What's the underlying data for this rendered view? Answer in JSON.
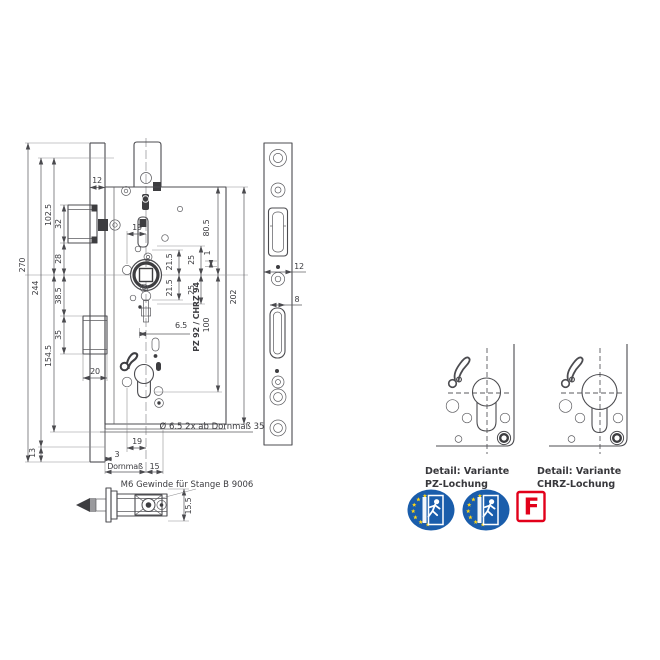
{
  "colors": {
    "line_gray": "#4c4c50",
    "text_gray": "#3c3c40",
    "badge_blue": "#1a5dab",
    "star_yellow": "#ffd617",
    "fire_red": "#e2001a"
  },
  "drawing": {
    "overall": {
      "h270": "270",
      "h244": "244",
      "h102_5": "102.5",
      "h154_5": "154.5",
      "h13": "13"
    },
    "chain": {
      "s32": "32",
      "s28": "28",
      "s38_5": "38.5",
      "s35": "35"
    },
    "top": {
      "w12": "12"
    },
    "cutout": {
      "w20": "20"
    },
    "center": {
      "b19": "19",
      "u21_5": "21.5",
      "l21_5": "21.5",
      "u25": "25",
      "l25": "25",
      "off1": "1",
      "h80_5": "80.5",
      "h100": "100",
      "h202": "202",
      "w6_5": "6.5",
      "variant": "PZ 92 / CHRZ 94"
    },
    "bottom": {
      "holes_note": "Ø 6.5 2x ab Dornmaß 35",
      "b19": "19",
      "t3": "3",
      "dorn_label": "Dornmaß",
      "w15": "15"
    },
    "faceplate": {
      "w12": "12",
      "w8": "8"
    },
    "section": {
      "note": "M6 Gewinde für Stange B 9006",
      "h15_5": "15.5"
    }
  },
  "details": {
    "pz": {
      "line1": "Detail: Variante",
      "line2": "PZ-Lochung"
    },
    "chrz": {
      "line1": "Detail: Variante",
      "line2": "CHRZ-Lochung"
    }
  },
  "certs": {
    "fire_letter": "F"
  }
}
